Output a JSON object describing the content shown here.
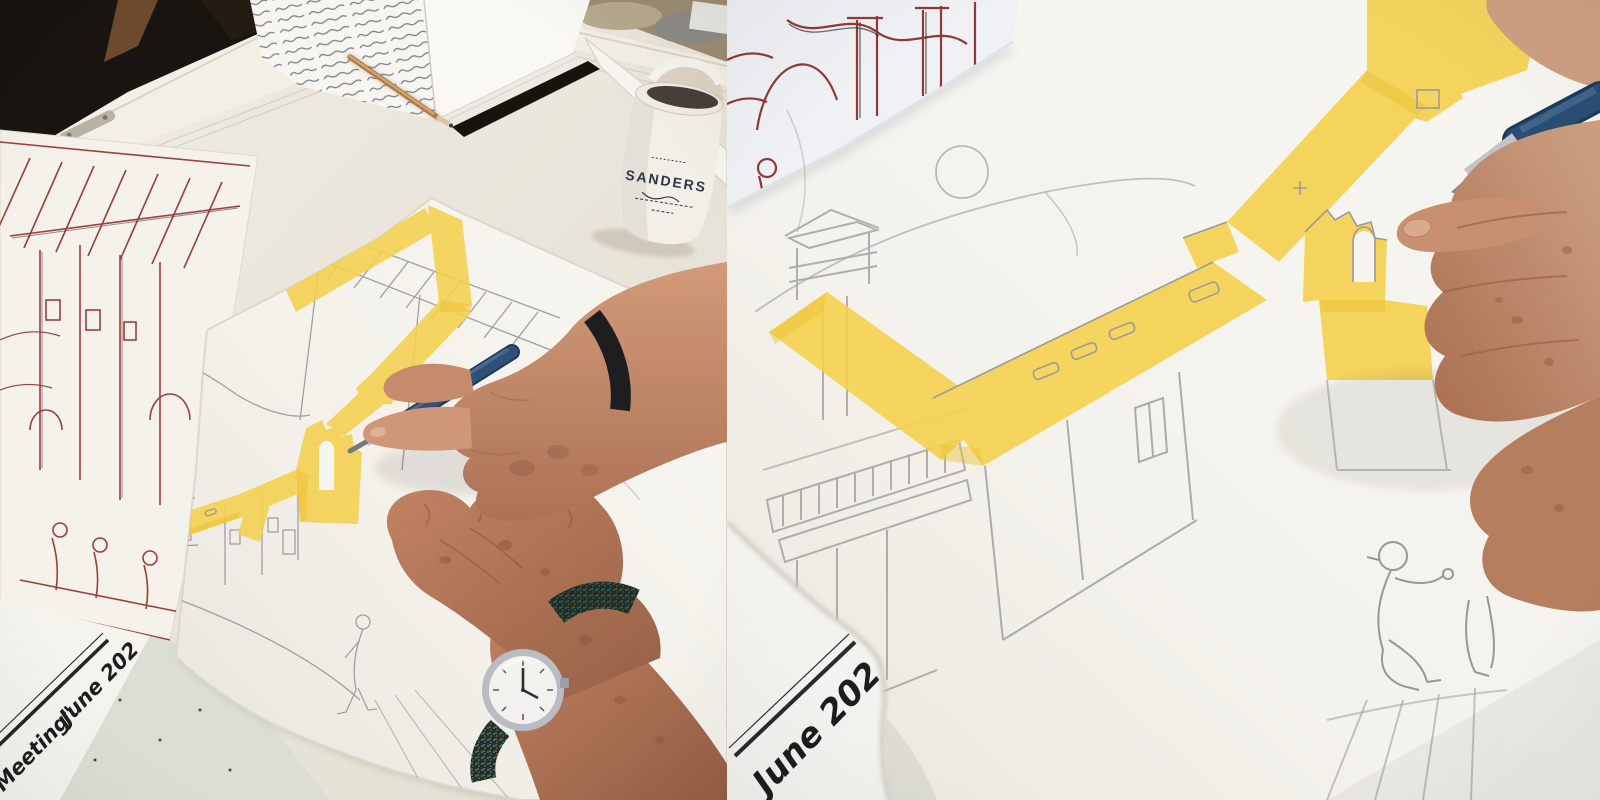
{
  "scene": {
    "description": "Two-frame photograph of an artist's hands tinting a pencil village sketch with yellow watercolor; journal, SANDERS mug and red-ink drawing on drafting table; right frame is a close-up."
  },
  "panels": {
    "left": {
      "mug_brand": "SANDERS",
      "caption_title": "Meeting\"",
      "caption_date": "June 202"
    },
    "right": {
      "caption_date": "June 202"
    }
  },
  "colors": {
    "wash_yellow": "#F2CE48",
    "ink_red": "#8E2F2B",
    "pencil_gray": "#9B9B9F",
    "brush_blue": "#2C4E74",
    "paper_white": "#F5F3EE",
    "desk": "#E8E4DA"
  }
}
